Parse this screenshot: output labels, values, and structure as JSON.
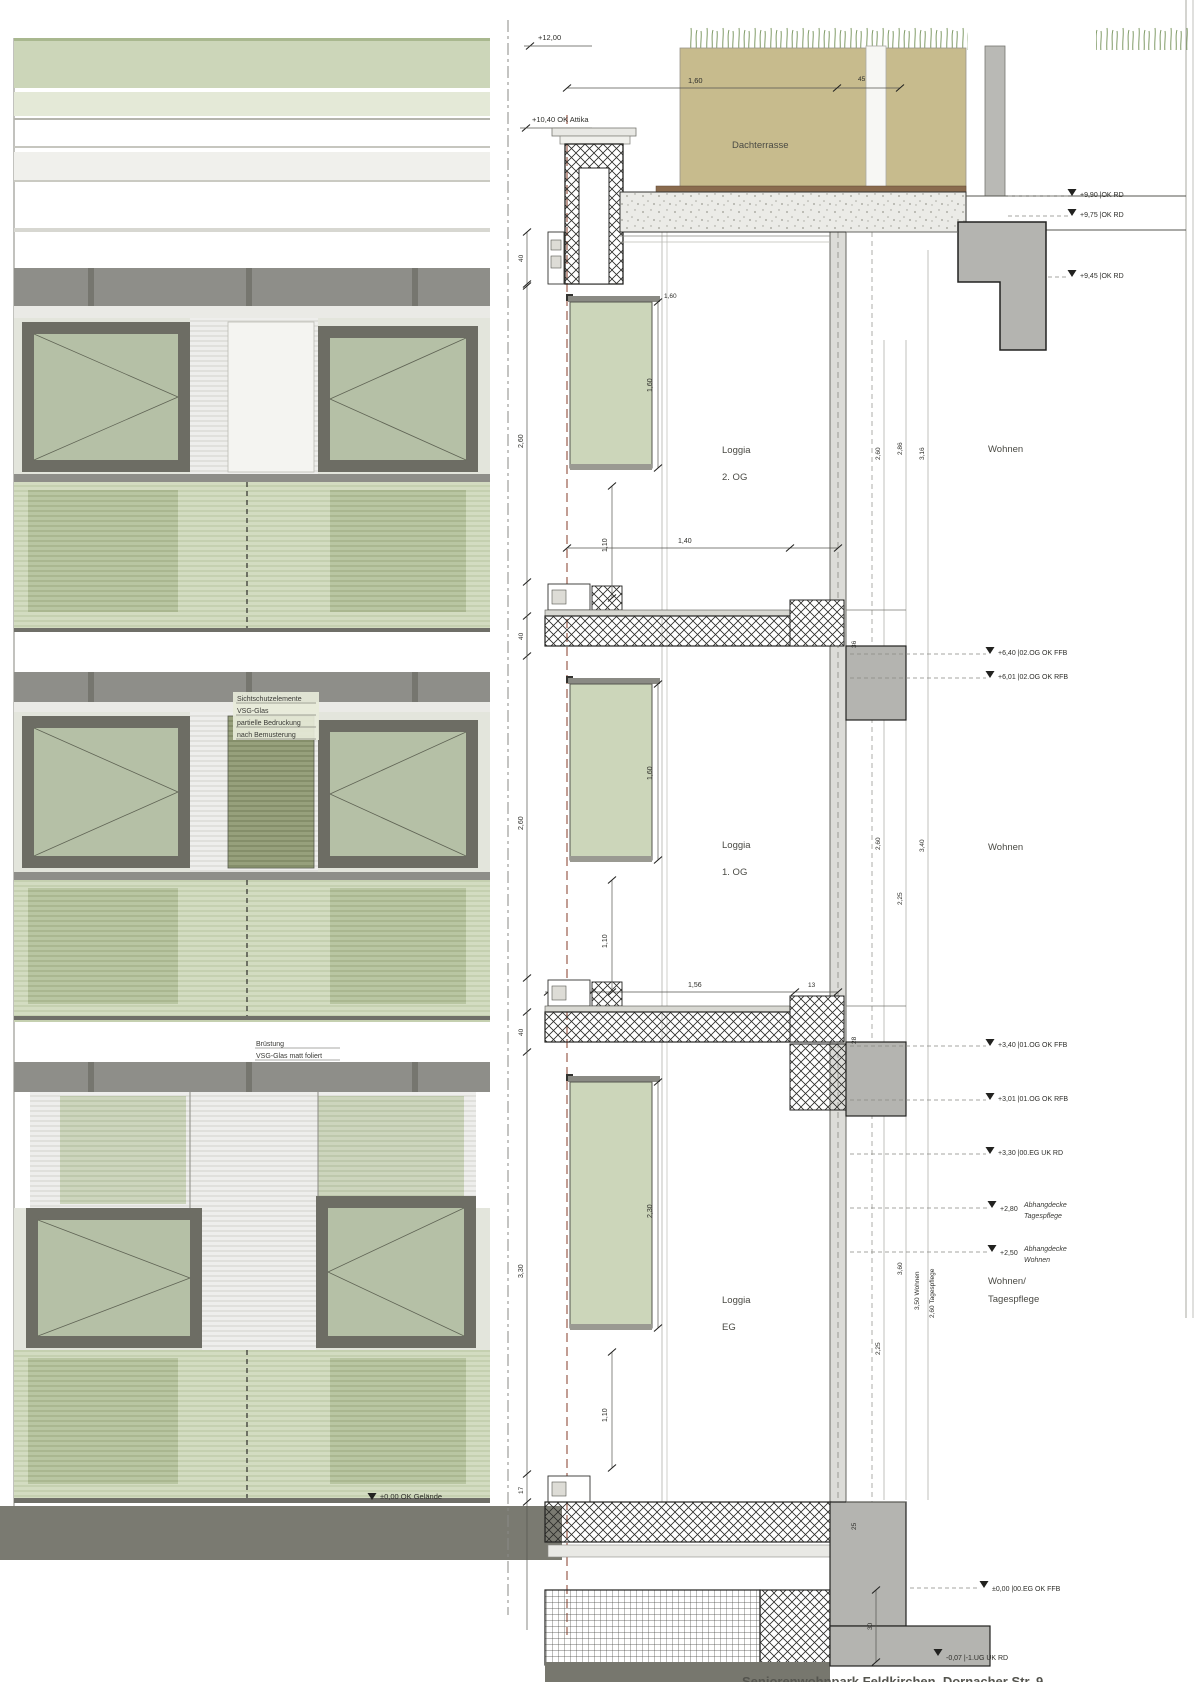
{
  "title": "Seniorenwohnpark Feldkirchen, Dornacher Str. 9",
  "colors": {
    "glass_green": "#b5c0a6",
    "panel_green": "#ccd6ba",
    "band_grey": "#8e8e89",
    "terrace_tan": "#c7bb8d",
    "axis_red": "#9a5c4c",
    "mass_grey": "#b4b4b0"
  },
  "facade": {
    "privacy_note": [
      "Sichtschutzelemente",
      "VSG-Glas",
      "partielle Bedruckung",
      "nach Bemusterung"
    ],
    "parapet_note": [
      "Brüstung",
      "VSG-Glas matt foliert",
      "(emailliert)"
    ],
    "ground_level": "±0,00 OK Gelände"
  },
  "section": {
    "terrace": "Dachterrasse",
    "levels": {
      "l1200": "+12,00",
      "attika": "+10,40  OK Attika",
      "l990": "+9,90  |OK RD",
      "l975": "+9,75  |OK RD",
      "l945": "+9,45  |OK RD",
      "l640": "+6,40  |02.OG OK FFB",
      "l601": "+6,01  |02.OG OK RFB",
      "l340": "+3,40  |01.OG OK FFB",
      "l301": "+3,01  |01.OG OK RFB",
      "l330": "+3,30  |00.EG UK RD",
      "l280": "+2,80",
      "l250": "+2,50",
      "l000": "±0,00  |00.EG OK FFB",
      "lm007": "-0,07  |-1.UG UK RD"
    },
    "ceiling_notes": {
      "a1": "Abhangdecke",
      "a2": "Tagespflege",
      "b1": "Abhangdecke",
      "b2": "Wohnen"
    },
    "rooms": {
      "loggia2a": "Loggia",
      "loggia2b": "2. OG",
      "wohnen2": "Wohnen",
      "loggia1a": "Loggia",
      "loggia1b": "1. OG",
      "wohnen1": "Wohnen",
      "loggia0a": "Loggia",
      "loggia0b": "EG",
      "wohnen0a": "Wohnen/",
      "wohnen0b": "Tagespflege"
    },
    "dims": {
      "d40": "40",
      "d160": "1,60",
      "d230": "2,30",
      "d110": "1,10",
      "d260": "2,60",
      "d330": "3,30",
      "d140": "1,40",
      "d90": "90",
      "d156": "1,56",
      "d13": "13",
      "d45": "45",
      "d286": "2,86",
      "d316": "3,16",
      "d225": "2,25",
      "d340": "3,40",
      "d360": "3,60",
      "w350": "3,50  Wohnen",
      "t260": "2,60  Tagespflege",
      "d30": "30",
      "d35": "35",
      "d36": "36",
      "d28": "28",
      "d25": "25",
      "d17": "17"
    }
  }
}
